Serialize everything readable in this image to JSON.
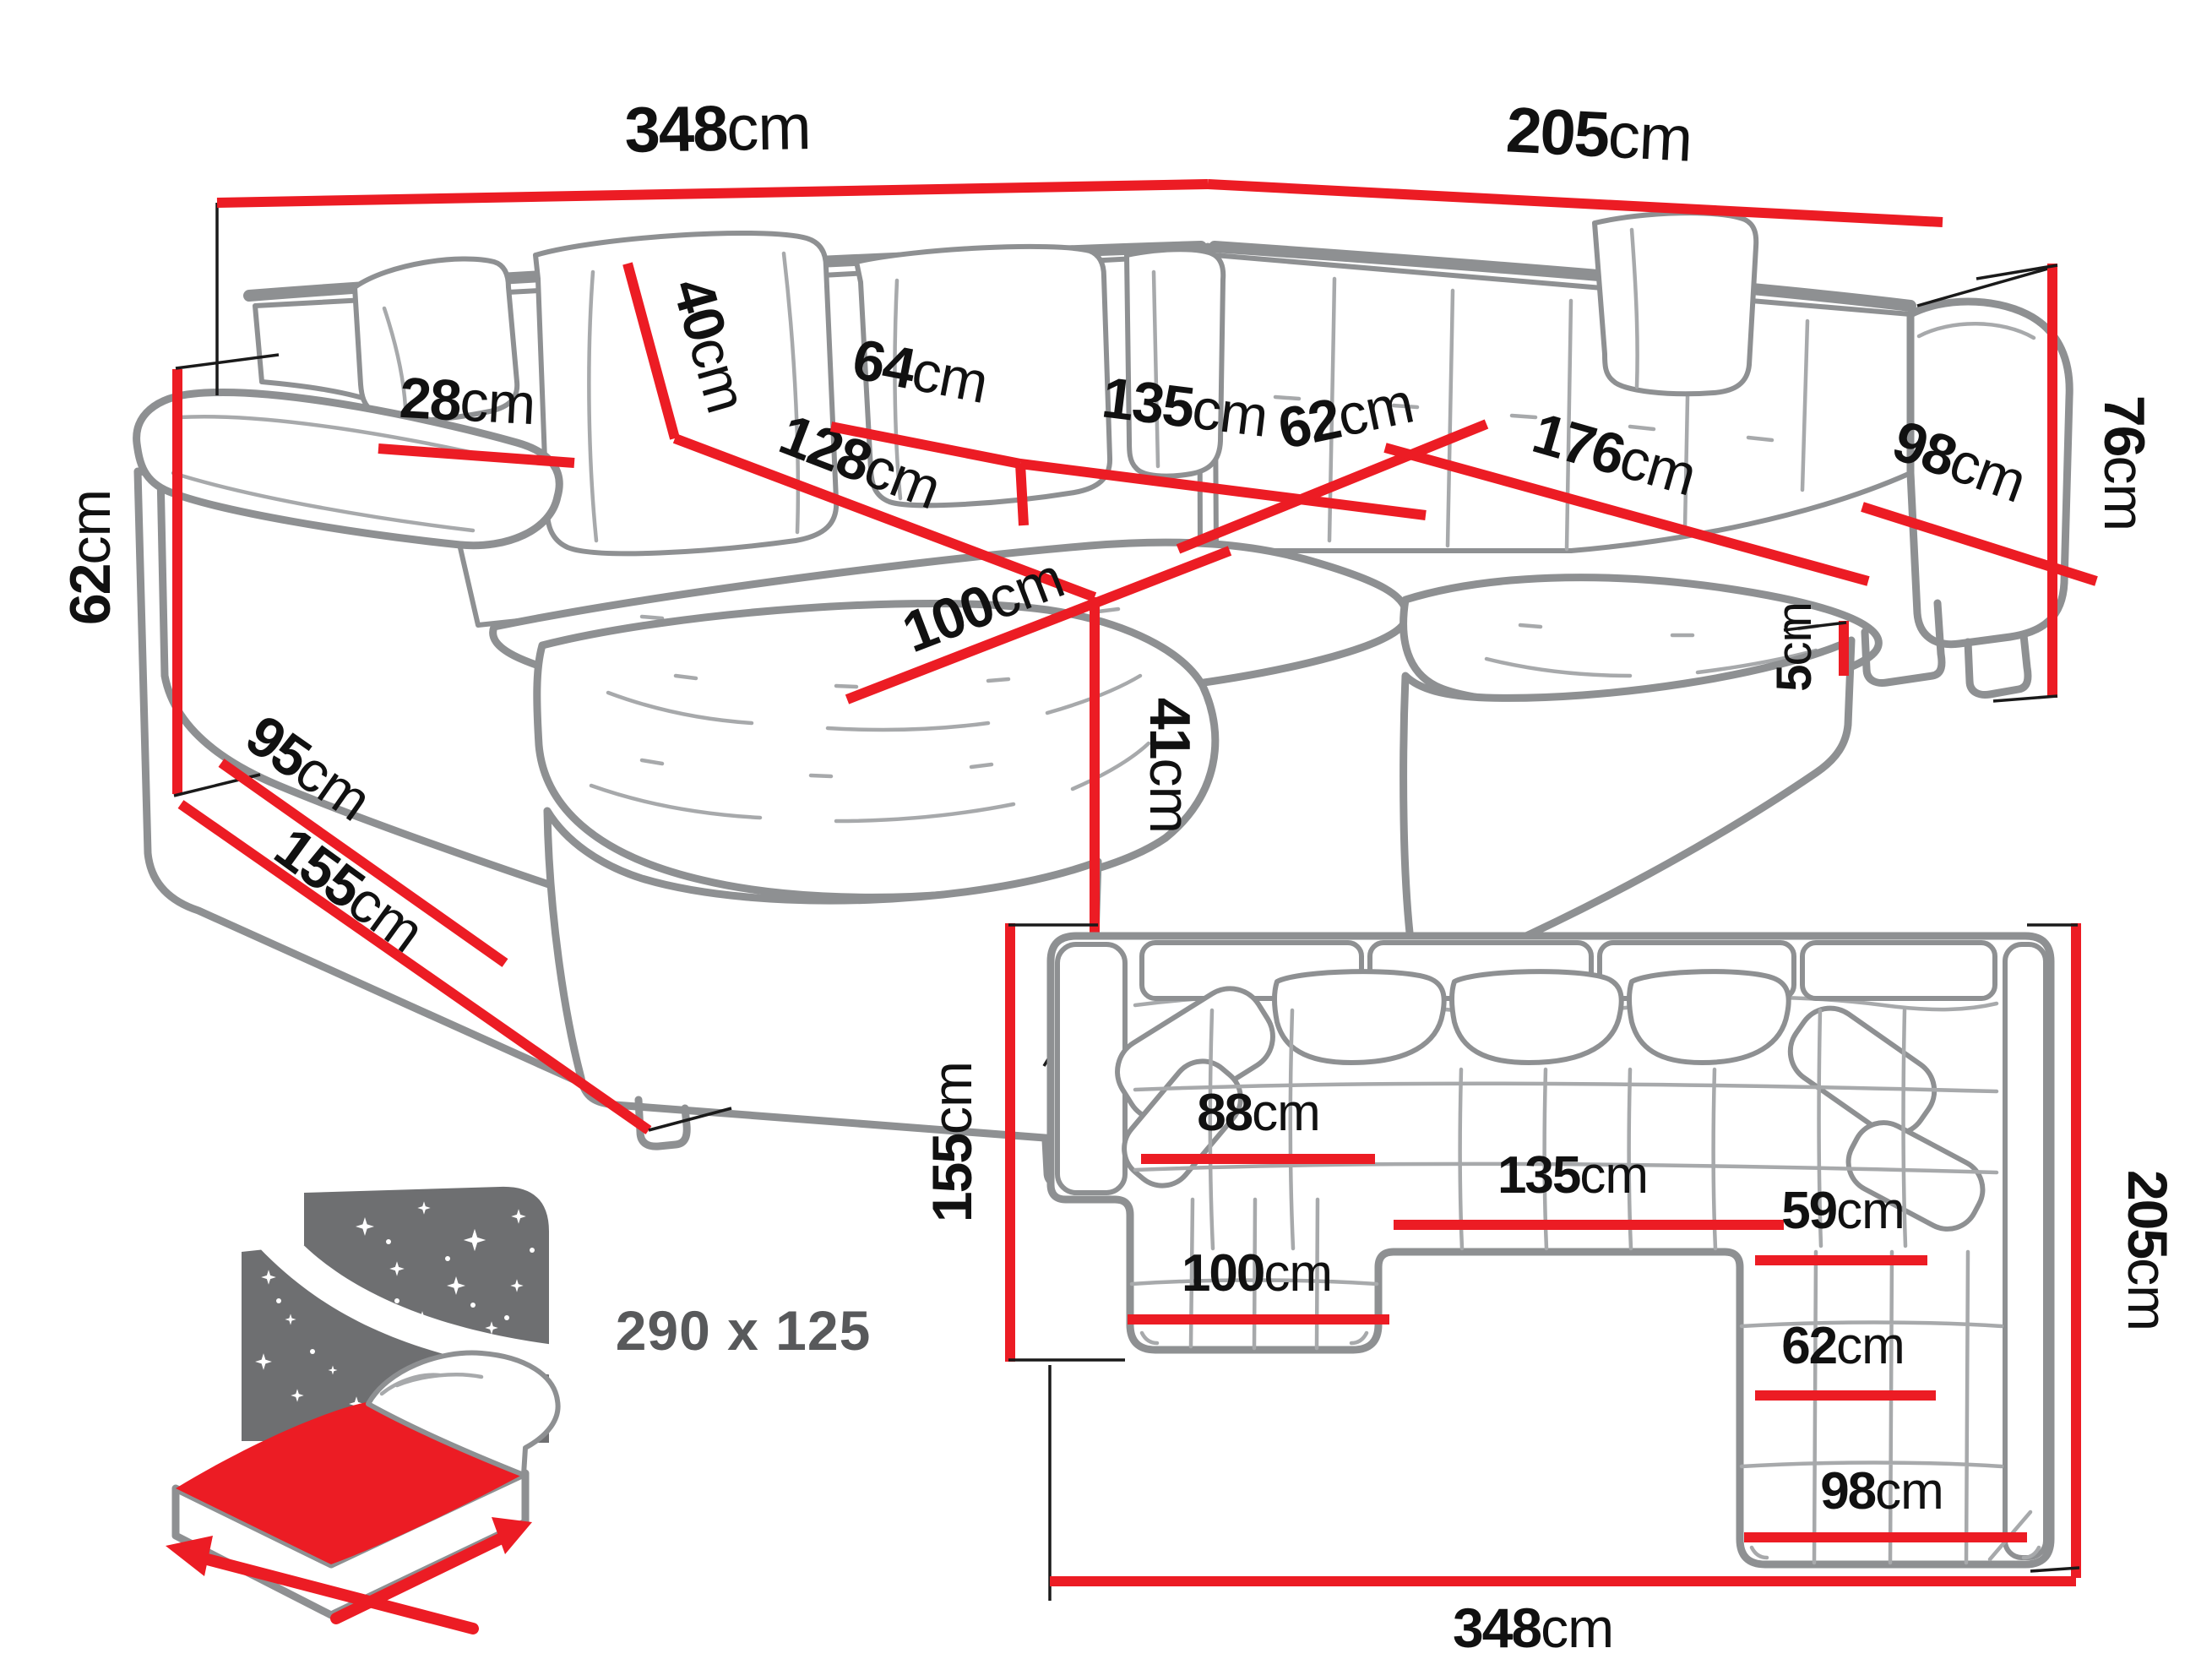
{
  "colors": {
    "dimension_red": "#ec1c24",
    "outline_gray": "#8e9092",
    "label_black": "#111111",
    "bed_icon_gray": "#6e6f71",
    "bed_text_gray": "#58595b"
  },
  "perspective": {
    "dims": {
      "back_width": {
        "num": "348",
        "unit": "cm"
      },
      "right_back_width": {
        "num": "205",
        "unit": "cm"
      },
      "pillow_height": {
        "num": "40",
        "unit": "cm"
      },
      "armrest_width": {
        "num": "28",
        "unit": "cm"
      },
      "seat_depth_left": {
        "num": "64",
        "unit": "cm"
      },
      "middle_seat_width": {
        "num": "135",
        "unit": "cm"
      },
      "chaise_length": {
        "num": "128",
        "unit": "cm"
      },
      "corner_seat_depth": {
        "num": "62",
        "unit": "cm"
      },
      "right_seat_length": {
        "num": "176",
        "unit": "cm"
      },
      "right_end_width": {
        "num": "98",
        "unit": "cm"
      },
      "backrest_height": {
        "num": "76",
        "unit": "cm"
      },
      "armrest_height": {
        "num": "62",
        "unit": "cm"
      },
      "side_depth": {
        "num": "95",
        "unit": "cm"
      },
      "chaise_floor_depth": {
        "num": "155",
        "unit": "cm"
      },
      "chaise_width": {
        "num": "100",
        "unit": "cm"
      },
      "seat_height": {
        "num": "41",
        "unit": "cm"
      },
      "leg_height": {
        "num": "5",
        "unit": "cm"
      }
    }
  },
  "plan": {
    "dims": {
      "left_depth": {
        "num": "155",
        "unit": "cm"
      },
      "right_depth": {
        "num": "205",
        "unit": "cm"
      },
      "total_width": {
        "num": "348",
        "unit": "cm"
      },
      "chaise_seat_width": {
        "num": "88",
        "unit": "cm"
      },
      "middle_seat_width": {
        "num": "135",
        "unit": "cm"
      },
      "corner_seat_width": {
        "num": "59",
        "unit": "cm"
      },
      "right_seat_width": {
        "num": "62",
        "unit": "cm"
      },
      "chaise_width": {
        "num": "100",
        "unit": "cm"
      },
      "right_end_width": {
        "num": "98",
        "unit": "cm"
      }
    }
  },
  "bed": {
    "sleeping_area": "290 x 125"
  }
}
